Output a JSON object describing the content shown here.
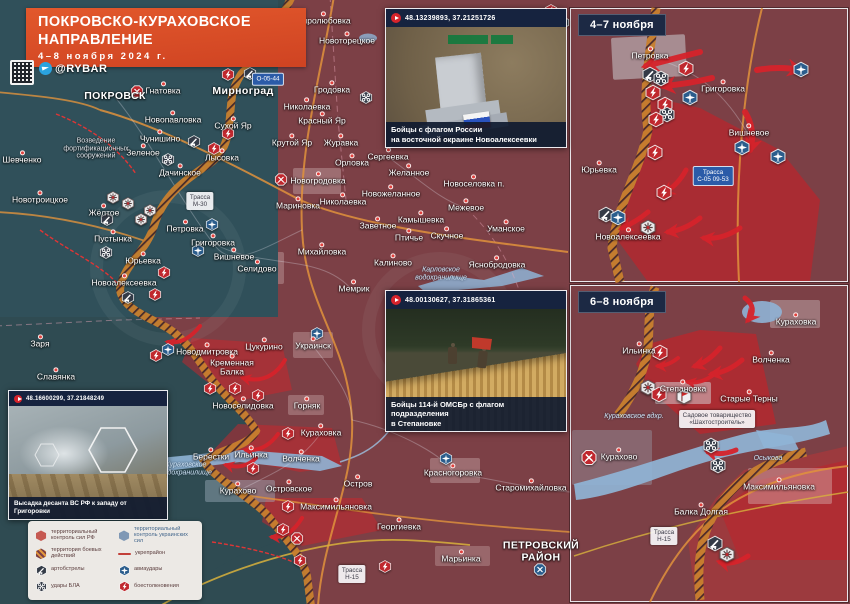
{
  "header": {
    "title_line1": "ПОКРОВСКО-КУРАХОВСКОЕ",
    "title_line2": "НАПРАВЛЕНИЕ",
    "date_range": "4–8 ноября 2024 г.",
    "channel_handle": "@RYBAR"
  },
  "map_insets": [
    {
      "label": "4–7 ноября"
    },
    {
      "label": "6–8 ноября"
    }
  ],
  "photo_insets": [
    {
      "coords": "48.13239893, 37.21251726",
      "caption_line1": "Бойцы с флагом России",
      "caption_line2": "на восточной окраине Новоалексеевки"
    },
    {
      "coords": "48.00130627, 37.31865361",
      "caption_line1": "Бойцы 114-й ОМСБр с флагом подразделения",
      "caption_line2": "в Степановке"
    },
    {
      "coords": "48.16600299, 37.21848249",
      "caption_line1": "Высадка десанта ВС РФ к западу от Григоровки",
      "caption_line2": ""
    }
  ],
  "legend": {
    "items": [
      {
        "icon": "zone-rf",
        "label": "территориальный контроль сил РФ",
        "tone": "red"
      },
      {
        "icon": "zone-battle",
        "label": "территория боевых действий",
        "tone": "red"
      },
      {
        "icon": "artillery",
        "label": "артобстрелы",
        "tone": "dark"
      },
      {
        "icon": "uav",
        "label": "удары БЛА",
        "tone": "dark"
      },
      {
        "icon": "zone-ua",
        "label": "территориальный контроль украинских сил",
        "tone": "blue"
      },
      {
        "icon": "fortline",
        "label": "укрепрайон",
        "tone": "red"
      },
      {
        "icon": "airstrike",
        "label": "авиаудары",
        "tone": "dark"
      },
      {
        "icon": "clash",
        "label": "боестолкновения",
        "tone": "dark"
      }
    ]
  },
  "map_labels": [
    {
      "t": "ПОКРОВСК",
      "x": 115,
      "y": 97,
      "cls": "c"
    },
    {
      "t": "Гнатовка",
      "x": 163,
      "y": 91,
      "cls": "t"
    },
    {
      "t": "Мирноград",
      "x": 243,
      "y": 92,
      "cls": "c"
    },
    {
      "t": "Новопавловка",
      "x": 173,
      "y": 120,
      "cls": "t"
    },
    {
      "t": "Сухой Яр",
      "x": 233,
      "y": 126,
      "cls": "t"
    },
    {
      "t": "Чунишино",
      "x": 160,
      "y": 139,
      "cls": "t"
    },
    {
      "t": "Зеленое",
      "x": 143,
      "y": 153,
      "cls": "t"
    },
    {
      "t": "Лысовка",
      "x": 222,
      "y": 158,
      "cls": "t"
    },
    {
      "t": "Дачинское",
      "x": 180,
      "y": 173,
      "cls": "t"
    },
    {
      "t": "Шевченко",
      "x": 22,
      "y": 160,
      "cls": "t"
    },
    {
      "t": "Новотроицкое",
      "x": 40,
      "y": 200,
      "cls": "t"
    },
    {
      "t": "Жёлтое",
      "x": 104,
      "y": 213,
      "cls": "t"
    },
    {
      "t": "Пустынка",
      "x": 113,
      "y": 239,
      "cls": "t"
    },
    {
      "t": "Петровка",
      "x": 185,
      "y": 229,
      "cls": "t"
    },
    {
      "t": "Григоровка",
      "x": 213,
      "y": 243,
      "cls": "t"
    },
    {
      "t": "Вишневое",
      "x": 234,
      "y": 257,
      "cls": "t"
    },
    {
      "t": "Юрьевка",
      "x": 143,
      "y": 261,
      "cls": "t"
    },
    {
      "t": "Новоалексеевка",
      "x": 124,
      "y": 283,
      "cls": "t"
    },
    {
      "t": "Миролюбовка",
      "x": 323,
      "y": 21,
      "cls": "t"
    },
    {
      "t": "Новоторецкое",
      "x": 347,
      "y": 41,
      "cls": "t"
    },
    {
      "t": "Гродовка",
      "x": 332,
      "y": 90,
      "cls": "t"
    },
    {
      "t": "Николаевка",
      "x": 307,
      "y": 107,
      "cls": "t"
    },
    {
      "t": "Красный Яр",
      "x": 322,
      "y": 121,
      "cls": "t"
    },
    {
      "t": "Крутой Яр",
      "x": 292,
      "y": 143,
      "cls": "t"
    },
    {
      "t": "Журавка",
      "x": 341,
      "y": 143,
      "cls": "t"
    },
    {
      "t": "Орловка",
      "x": 352,
      "y": 163,
      "cls": "t"
    },
    {
      "t": "Сергеевка",
      "x": 388,
      "y": 157,
      "cls": "t"
    },
    {
      "t": "Новогродовка",
      "x": 318,
      "y": 181,
      "cls": "t"
    },
    {
      "t": "Мариновка",
      "x": 298,
      "y": 206,
      "cls": "t"
    },
    {
      "t": "Николаевка",
      "x": 343,
      "y": 202,
      "cls": "t"
    },
    {
      "t": "Заветное",
      "x": 378,
      "y": 226,
      "cls": "t"
    },
    {
      "t": "Михайловка",
      "x": 322,
      "y": 252,
      "cls": "t"
    },
    {
      "t": "Селидово",
      "x": 257,
      "y": 269,
      "cls": "t"
    },
    {
      "t": "Мемрик",
      "x": 354,
      "y": 289,
      "cls": "t"
    },
    {
      "t": "Калиново",
      "x": 393,
      "y": 263,
      "cls": "t"
    },
    {
      "t": "Желанное",
      "x": 409,
      "y": 173,
      "cls": "t"
    },
    {
      "t": "Новожеланное",
      "x": 391,
      "y": 194,
      "cls": "t"
    },
    {
      "t": "Новоселовка п.",
      "x": 474,
      "y": 184,
      "cls": "t"
    },
    {
      "t": "Межевое",
      "x": 466,
      "y": 208,
      "cls": "t"
    },
    {
      "t": "Камышевка",
      "x": 421,
      "y": 220,
      "cls": "t"
    },
    {
      "t": "Птичье",
      "x": 409,
      "y": 238,
      "cls": "t"
    },
    {
      "t": "Скучное",
      "x": 447,
      "y": 236,
      "cls": "t"
    },
    {
      "t": "Уманское",
      "x": 506,
      "y": 229,
      "cls": "t"
    },
    {
      "t": "Яснобродовка",
      "x": 497,
      "y": 265,
      "cls": "t"
    },
    {
      "t": "Заря",
      "x": 40,
      "y": 344,
      "cls": "t"
    },
    {
      "t": "Славянка",
      "x": 56,
      "y": 377,
      "cls": "t"
    },
    {
      "t": "Новодмитровка",
      "x": 207,
      "y": 352,
      "cls": "t"
    },
    {
      "t": "Цукурино",
      "x": 264,
      "y": 347,
      "cls": "t"
    },
    {
      "t": "Украинск",
      "x": 313,
      "y": 346,
      "cls": "t"
    },
    {
      "t": "Кременная\nБалка",
      "x": 232,
      "y": 368,
      "cls": "t"
    },
    {
      "t": "Новоселидовка",
      "x": 243,
      "y": 406,
      "cls": "t"
    },
    {
      "t": "Горняк",
      "x": 307,
      "y": 406,
      "cls": "t"
    },
    {
      "t": "Кураховка",
      "x": 321,
      "y": 433,
      "cls": "t"
    },
    {
      "t": "Берестки",
      "x": 211,
      "y": 457,
      "cls": "t"
    },
    {
      "t": "Ильинка",
      "x": 251,
      "y": 455,
      "cls": "t"
    },
    {
      "t": "Волченка",
      "x": 301,
      "y": 459,
      "cls": "t"
    },
    {
      "t": "Островское",
      "x": 289,
      "y": 489,
      "cls": "t"
    },
    {
      "t": "Остров",
      "x": 358,
      "y": 484,
      "cls": "t"
    },
    {
      "t": "Максимильяновка",
      "x": 336,
      "y": 507,
      "cls": "t"
    },
    {
      "t": "Георгиевка",
      "x": 399,
      "y": 527,
      "cls": "t"
    },
    {
      "t": "Красногоровка",
      "x": 453,
      "y": 473,
      "cls": "t"
    },
    {
      "t": "Старомихайловка",
      "x": 531,
      "y": 488,
      "cls": "t"
    },
    {
      "t": "Марьинка",
      "x": 461,
      "y": 559,
      "cls": "t"
    },
    {
      "t": "Курахово",
      "x": 238,
      "y": 491,
      "cls": "t"
    },
    {
      "t": "ПЕТРОВСКИЙ\nРАЙОН",
      "x": 541,
      "y": 552,
      "cls": "c"
    },
    {
      "t": "Кураховское\nводохранилище",
      "x": 186,
      "y": 469,
      "cls": "w"
    },
    {
      "t": "Карловское\nводохранилище",
      "x": 441,
      "y": 274,
      "cls": "w"
    },
    {
      "t": "Возведение\nфортификационных\nсооружений",
      "x": 96,
      "y": 149,
      "cls": "n"
    },
    {
      "t": "Петровка",
      "x": 650,
      "y": 56,
      "cls": "t"
    },
    {
      "t": "Григоровка",
      "x": 723,
      "y": 89,
      "cls": "t"
    },
    {
      "t": "Вишневое",
      "x": 749,
      "y": 133,
      "cls": "t"
    },
    {
      "t": "Юрьевка",
      "x": 599,
      "y": 170,
      "cls": "t"
    },
    {
      "t": "Новоалексеевка",
      "x": 628,
      "y": 237,
      "cls": "t"
    },
    {
      "t": "Кураховка",
      "x": 796,
      "y": 322,
      "cls": "t"
    },
    {
      "t": "Ильинка",
      "x": 639,
      "y": 351,
      "cls": "t"
    },
    {
      "t": "Волченка",
      "x": 771,
      "y": 360,
      "cls": "t"
    },
    {
      "t": "Степановка",
      "x": 683,
      "y": 389,
      "cls": "t"
    },
    {
      "t": "Старые Терны",
      "x": 749,
      "y": 399,
      "cls": "t"
    },
    {
      "t": "Курахово",
      "x": 619,
      "y": 457,
      "cls": "t"
    },
    {
      "t": "Максимильяновка",
      "x": 779,
      "y": 487,
      "cls": "t"
    },
    {
      "t": "Балка Долгая",
      "x": 701,
      "y": 512,
      "cls": "t"
    },
    {
      "t": "Кураховское вдхр.",
      "x": 634,
      "y": 417,
      "cls": "w"
    },
    {
      "t": "Осыкова",
      "x": 768,
      "y": 459,
      "cls": "w"
    }
  ],
  "road_labels": [
    {
      "l1": "Трасса",
      "l2": "М-30",
      "x": 200,
      "y": 201,
      "style": "wb"
    },
    {
      "l1": "О-05-44",
      "l2": "",
      "x": 268,
      "y": 79,
      "style": "bb"
    },
    {
      "l1": "Трасса",
      "l2": "Н-15",
      "x": 352,
      "y": 574,
      "style": "wb"
    },
    {
      "l1": "Трасса",
      "l2": "С-05 09-53",
      "x": 713,
      "y": 176,
      "style": "bb"
    },
    {
      "l1": "Трасса",
      "l2": "Н-15",
      "x": 664,
      "y": 536,
      "style": "wb"
    },
    {
      "l1": "Садовое товарищество",
      "l2": "«Шахтостроитель»",
      "x": 717,
      "y": 419,
      "style": "wb"
    }
  ],
  "markers": [
    {
      "t": "battle",
      "x": 137,
      "y": 94
    },
    {
      "t": "clash",
      "x": 228,
      "y": 77
    },
    {
      "t": "artillery",
      "x": 250,
      "y": 76
    },
    {
      "t": "uav",
      "x": 366,
      "y": 100
    },
    {
      "t": "artillery",
      "x": 194,
      "y": 144
    },
    {
      "t": "clash",
      "x": 228,
      "y": 136
    },
    {
      "t": "clash",
      "x": 214,
      "y": 151
    },
    {
      "t": "uav",
      "x": 168,
      "y": 162
    },
    {
      "t": "shell",
      "x": 113,
      "y": 200
    },
    {
      "t": "shell",
      "x": 128,
      "y": 206
    },
    {
      "t": "shell",
      "x": 150,
      "y": 213
    },
    {
      "t": "artillery",
      "x": 107,
      "y": 222
    },
    {
      "t": "shell",
      "x": 141,
      "y": 222
    },
    {
      "t": "airstrike",
      "x": 212,
      "y": 227
    },
    {
      "t": "airstrike",
      "x": 198,
      "y": 253
    },
    {
      "t": "uav",
      "x": 106,
      "y": 255
    },
    {
      "t": "clash",
      "x": 164,
      "y": 275
    },
    {
      "t": "clash",
      "x": 155,
      "y": 297
    },
    {
      "t": "artillery",
      "x": 128,
      "y": 300
    },
    {
      "t": "battle",
      "x": 281,
      "y": 182
    },
    {
      "t": "clash",
      "x": 156,
      "y": 358
    },
    {
      "t": "airstrike",
      "x": 168,
      "y": 352
    },
    {
      "t": "airstrike",
      "x": 317,
      "y": 336
    },
    {
      "t": "clash",
      "x": 210,
      "y": 391
    },
    {
      "t": "clash",
      "x": 235,
      "y": 391
    },
    {
      "t": "clash",
      "x": 258,
      "y": 398
    },
    {
      "t": "clash",
      "x": 288,
      "y": 436
    },
    {
      "t": "clash",
      "x": 253,
      "y": 471
    },
    {
      "t": "clash",
      "x": 288,
      "y": 509
    },
    {
      "t": "clash",
      "x": 283,
      "y": 532
    },
    {
      "t": "battle",
      "x": 297,
      "y": 541
    },
    {
      "t": "airstrike",
      "x": 446,
      "y": 461
    },
    {
      "t": "battleblue",
      "x": 540,
      "y": 572
    },
    {
      "t": "clash",
      "x": 385,
      "y": 569
    },
    {
      "t": "clash",
      "x": 300,
      "y": 563
    },
    {
      "t": "clash",
      "x": 551,
      "y": 13
    },
    {
      "t": "artillery",
      "x": 563,
      "y": 25
    },
    {
      "t": "clash",
      "x": 686,
      "y": 71,
      "s": 16
    },
    {
      "t": "artillery",
      "x": 650,
      "y": 77,
      "s": 16
    },
    {
      "t": "uav",
      "x": 661,
      "y": 81,
      "s": 16
    },
    {
      "t": "clash",
      "x": 653,
      "y": 95,
      "s": 16
    },
    {
      "t": "airstrike",
      "x": 690,
      "y": 100,
      "s": 16
    },
    {
      "t": "clash",
      "x": 665,
      "y": 107,
      "s": 16
    },
    {
      "t": "uav",
      "x": 667,
      "y": 117,
      "s": 16
    },
    {
      "t": "clash",
      "x": 656,
      "y": 122,
      "s": 16
    },
    {
      "t": "airstrike",
      "x": 801,
      "y": 72,
      "s": 16
    },
    {
      "t": "airstrike",
      "x": 742,
      "y": 150,
      "s": 16
    },
    {
      "t": "airstrike",
      "x": 778,
      "y": 159,
      "s": 16
    },
    {
      "t": "clash",
      "x": 655,
      "y": 155,
      "s": 16
    },
    {
      "t": "clash",
      "x": 664,
      "y": 195,
      "s": 16
    },
    {
      "t": "artillery",
      "x": 606,
      "y": 217,
      "s": 16
    },
    {
      "t": "airstrike",
      "x": 618,
      "y": 220,
      "s": 16
    },
    {
      "t": "shell",
      "x": 648,
      "y": 230,
      "s": 16
    },
    {
      "t": "clash",
      "x": 660,
      "y": 355,
      "s": 16
    },
    {
      "t": "shell",
      "x": 648,
      "y": 390,
      "s": 16
    },
    {
      "t": "clash",
      "x": 659,
      "y": 397,
      "s": 16
    },
    {
      "t": "flag",
      "x": 684,
      "y": 399,
      "s": 16
    },
    {
      "t": "uav",
      "x": 711,
      "y": 448,
      "s": 16
    },
    {
      "t": "uav",
      "x": 718,
      "y": 468,
      "s": 16
    },
    {
      "t": "artillery",
      "x": 715,
      "y": 546,
      "s": 16
    },
    {
      "t": "shell",
      "x": 727,
      "y": 557,
      "s": 16
    },
    {
      "t": "battle",
      "x": 589,
      "y": 460,
      "s": 16
    }
  ],
  "arrows": [
    {
      "x1": 200,
      "y1": 326,
      "cx": 185,
      "cy": 345,
      "x2": 168,
      "y2": 342,
      "w": 4
    },
    {
      "x1": 285,
      "y1": 360,
      "cx": 270,
      "cy": 385,
      "x2": 243,
      "y2": 378,
      "w": 4
    },
    {
      "x1": 278,
      "y1": 434,
      "cx": 265,
      "cy": 452,
      "x2": 246,
      "y2": 450,
      "w": 4
    },
    {
      "x1": 256,
      "y1": 458,
      "cx": 244,
      "cy": 470,
      "x2": 226,
      "y2": 465,
      "w": 4
    },
    {
      "x1": 302,
      "y1": 518,
      "cx": 290,
      "cy": 538,
      "x2": 272,
      "y2": 537,
      "w": 4
    },
    {
      "x1": 700,
      "y1": 52,
      "cx": 668,
      "cy": 60,
      "x2": 646,
      "y2": 66,
      "w": 6
    },
    {
      "x1": 712,
      "y1": 78,
      "cx": 688,
      "cy": 84,
      "x2": 663,
      "y2": 86,
      "w": 6
    },
    {
      "x1": 757,
      "y1": 70,
      "cx": 780,
      "cy": 66,
      "x2": 800,
      "y2": 70,
      "w": 6
    },
    {
      "x1": 745,
      "y1": 112,
      "cx": 756,
      "cy": 130,
      "x2": 750,
      "y2": 150,
      "w": 6
    },
    {
      "x1": 686,
      "y1": 170,
      "cx": 678,
      "cy": 185,
      "x2": 664,
      "y2": 193,
      "w": 5
    },
    {
      "x1": 648,
      "y1": 212,
      "cx": 636,
      "cy": 222,
      "x2": 622,
      "y2": 228,
      "w": 5
    },
    {
      "x1": 700,
      "y1": 218,
      "cx": 685,
      "cy": 230,
      "x2": 668,
      "y2": 232,
      "w": 5
    },
    {
      "x1": 740,
      "y1": 228,
      "cx": 722,
      "cy": 240,
      "x2": 704,
      "y2": 238,
      "w": 5
    },
    {
      "x1": 745,
      "y1": 298,
      "cx": 758,
      "cy": 308,
      "x2": 748,
      "y2": 320,
      "w": 5
    },
    {
      "x1": 720,
      "y1": 348,
      "cx": 708,
      "cy": 362,
      "x2": 695,
      "y2": 366,
      "w": 5
    },
    {
      "x1": 742,
      "y1": 360,
      "cx": 728,
      "cy": 372,
      "x2": 712,
      "y2": 374,
      "w": 5
    },
    {
      "x1": 678,
      "y1": 358,
      "cx": 668,
      "cy": 366,
      "x2": 658,
      "y2": 366,
      "w": 4
    },
    {
      "x1": 712,
      "y1": 376,
      "cx": 700,
      "cy": 384,
      "x2": 688,
      "y2": 382,
      "w": 4
    },
    {
      "x1": 736,
      "y1": 450,
      "cx": 722,
      "cy": 456,
      "x2": 708,
      "y2": 452,
      "w": 5
    },
    {
      "x1": 748,
      "y1": 556,
      "cx": 734,
      "cy": 566,
      "x2": 720,
      "y2": 562,
      "w": 5
    }
  ],
  "colors": {
    "banner_orange": "#e2582c",
    "rf_zone": "#7c4046",
    "active_red": "#c8202a",
    "ua_zone": "#2f4b52",
    "ua_control_blue": "#40678a",
    "water": "#8fb4d6",
    "road_orange": "#e0923c",
    "navy_panel": "#1c2944",
    "legend_bg": "#ece9e5"
  }
}
